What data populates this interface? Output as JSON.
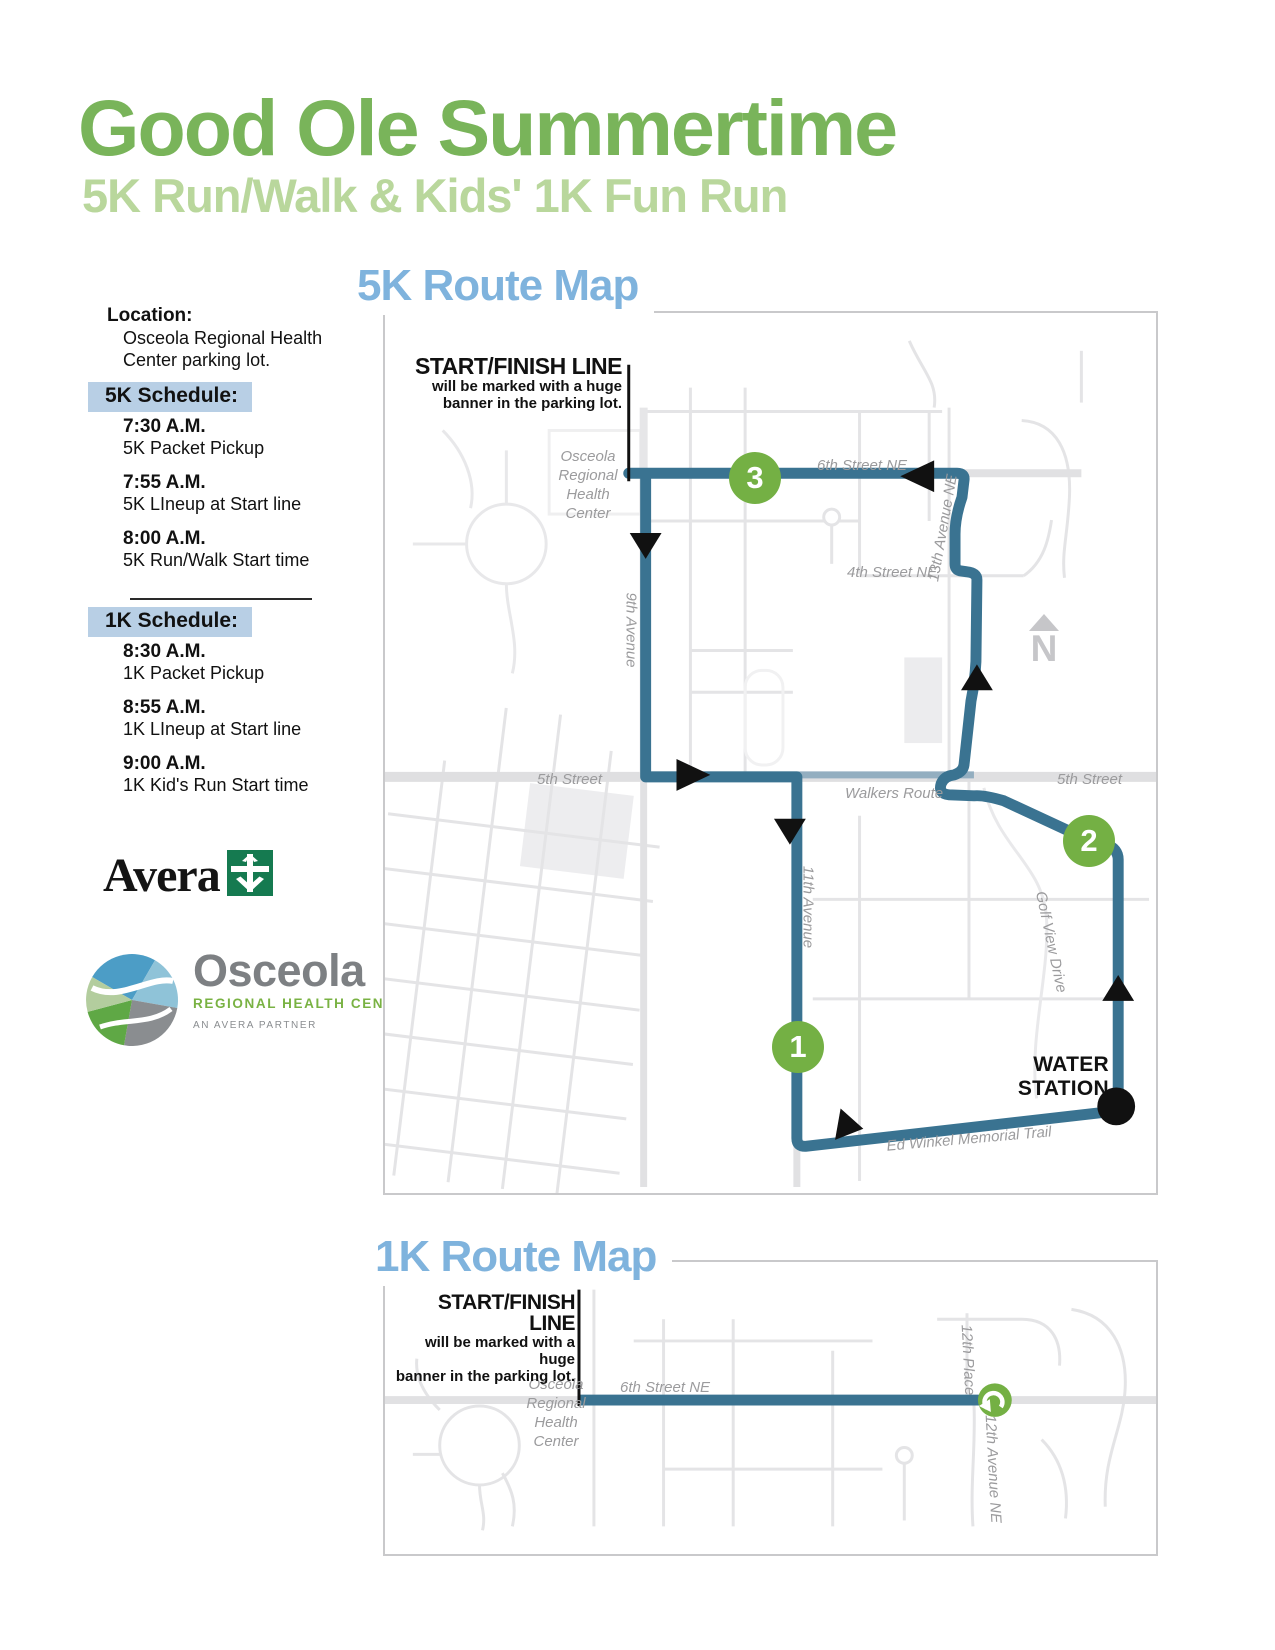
{
  "header": {
    "title": "Good Ole Summertime",
    "subtitle": "5K Run/Walk  & Kids' 1K Fun Run"
  },
  "sidebar": {
    "location_label": "Location:",
    "location_line1": "Osceola Regional Health",
    "location_line2": "Center parking lot.",
    "schedule_5k": {
      "header": "5K Schedule:",
      "items": [
        {
          "time": "7:30 A.M.",
          "desc": "5K Packet Pickup"
        },
        {
          "time": "7:55 A.M.",
          "desc": "5K LIneup at Start line"
        },
        {
          "time": "8:00 A.M.",
          "desc": "5K Run/Walk Start time"
        }
      ]
    },
    "schedule_1k": {
      "header": "1K Schedule:",
      "items": [
        {
          "time": "8:30 A.M.",
          "desc": "1K Packet Pickup"
        },
        {
          "time": "8:55 A.M.",
          "desc": "1K LIneup at Start line"
        },
        {
          "time": "9:00 A.M.",
          "desc": "1K Kid's Run Start time"
        }
      ]
    },
    "avera_logo_text": "Avera",
    "osceola_logo": {
      "name": "Osceola",
      "tagline": "REGIONAL HEALTH CENTER",
      "partner": "AN AVERA PARTNER"
    }
  },
  "map5k": {
    "heading": "5K Route Map",
    "start_finish": {
      "title": "START/FINISH LINE",
      "line1": "will be marked with a huge",
      "line2": "banner in the parking lot."
    },
    "hospital_label": [
      "Osceola",
      "Regional",
      "Health",
      "Center"
    ],
    "streets": {
      "s6": "6th Street NE",
      "s4": "4th Street NE",
      "s5_left": "5th Street",
      "s5_right": "5th Street",
      "walkers": "Walkers Route",
      "a9": "9th Avenue",
      "a11": "11th Avenue",
      "a13": "13th Avenue NE",
      "golf": "Golf View Drive",
      "trail": "Ed Winkel Memorial Trail"
    },
    "markers": {
      "m1": "1",
      "m2": "2",
      "m3": "3"
    },
    "water_station": [
      "WATER",
      "STATION"
    ],
    "compass_n": "N"
  },
  "map1k": {
    "heading": "1K Route Map",
    "start_finish": {
      "title": "START/FINISH LINE",
      "line1": "will be marked with a huge",
      "line2": "banner in the parking lot."
    },
    "hospital_label": [
      "Osceola",
      "Regional",
      "Health",
      "Center"
    ],
    "streets": {
      "s6": "6th Street NE",
      "p12": "12th Place",
      "a12": "12th Avenue NE"
    }
  },
  "colors": {
    "title_green": "#79b45a",
    "subtitle_green": "#b9d79c",
    "heading_blue": "#7fb3dd",
    "schedule_highlight": "#b8cfe5",
    "route_teal": "#3a7391",
    "walkers_route": "#93aec0",
    "marker_green": "#74b044",
    "street_gray": "#e4e4e6",
    "label_gray": "#9b9b9d"
  }
}
